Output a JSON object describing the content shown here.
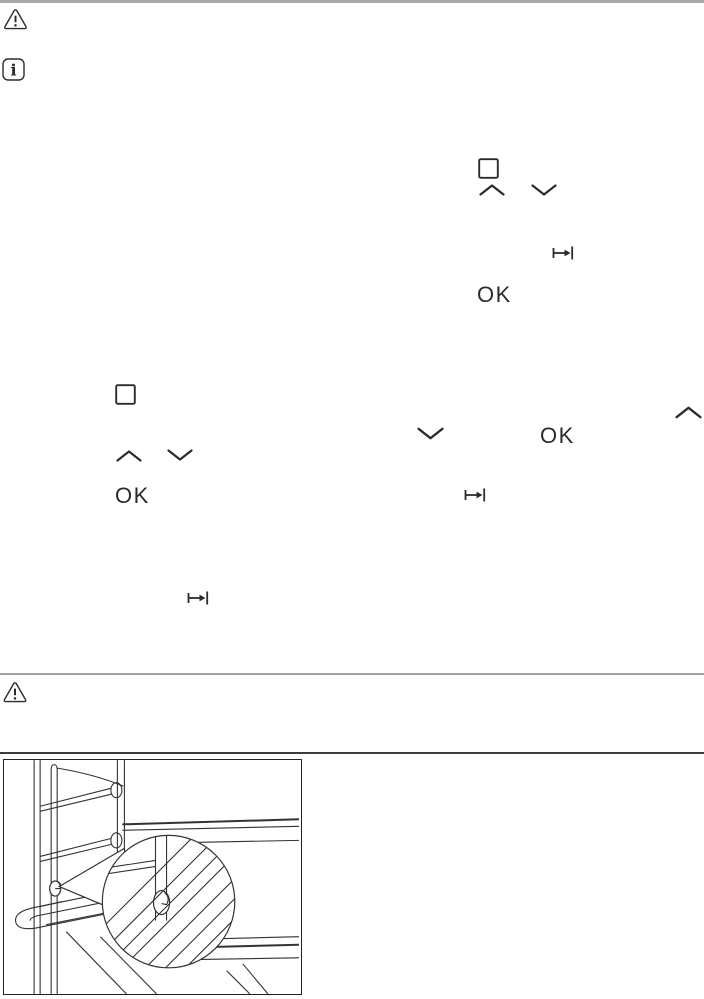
{
  "page": {
    "type": "manual-page-scan",
    "background": "#ffffff",
    "ink": "#2b2b2b",
    "accent_gray": "#a8a8a8"
  },
  "labels": {
    "ok": "OK"
  },
  "icons": {
    "warning_top": "warning-triangle",
    "info": "info-square",
    "display_frame_1": "square-outline",
    "display_frame_2": "square-outline",
    "up_arrows": "chevron-up",
    "down_arrows": "chevron-down",
    "tab_arrow": "arrow-to-bar",
    "warning_section": "warning-triangle"
  },
  "figure": {
    "alt": "oven-cavity-shelf-insertion-drawing-with-magnifier-detail"
  }
}
